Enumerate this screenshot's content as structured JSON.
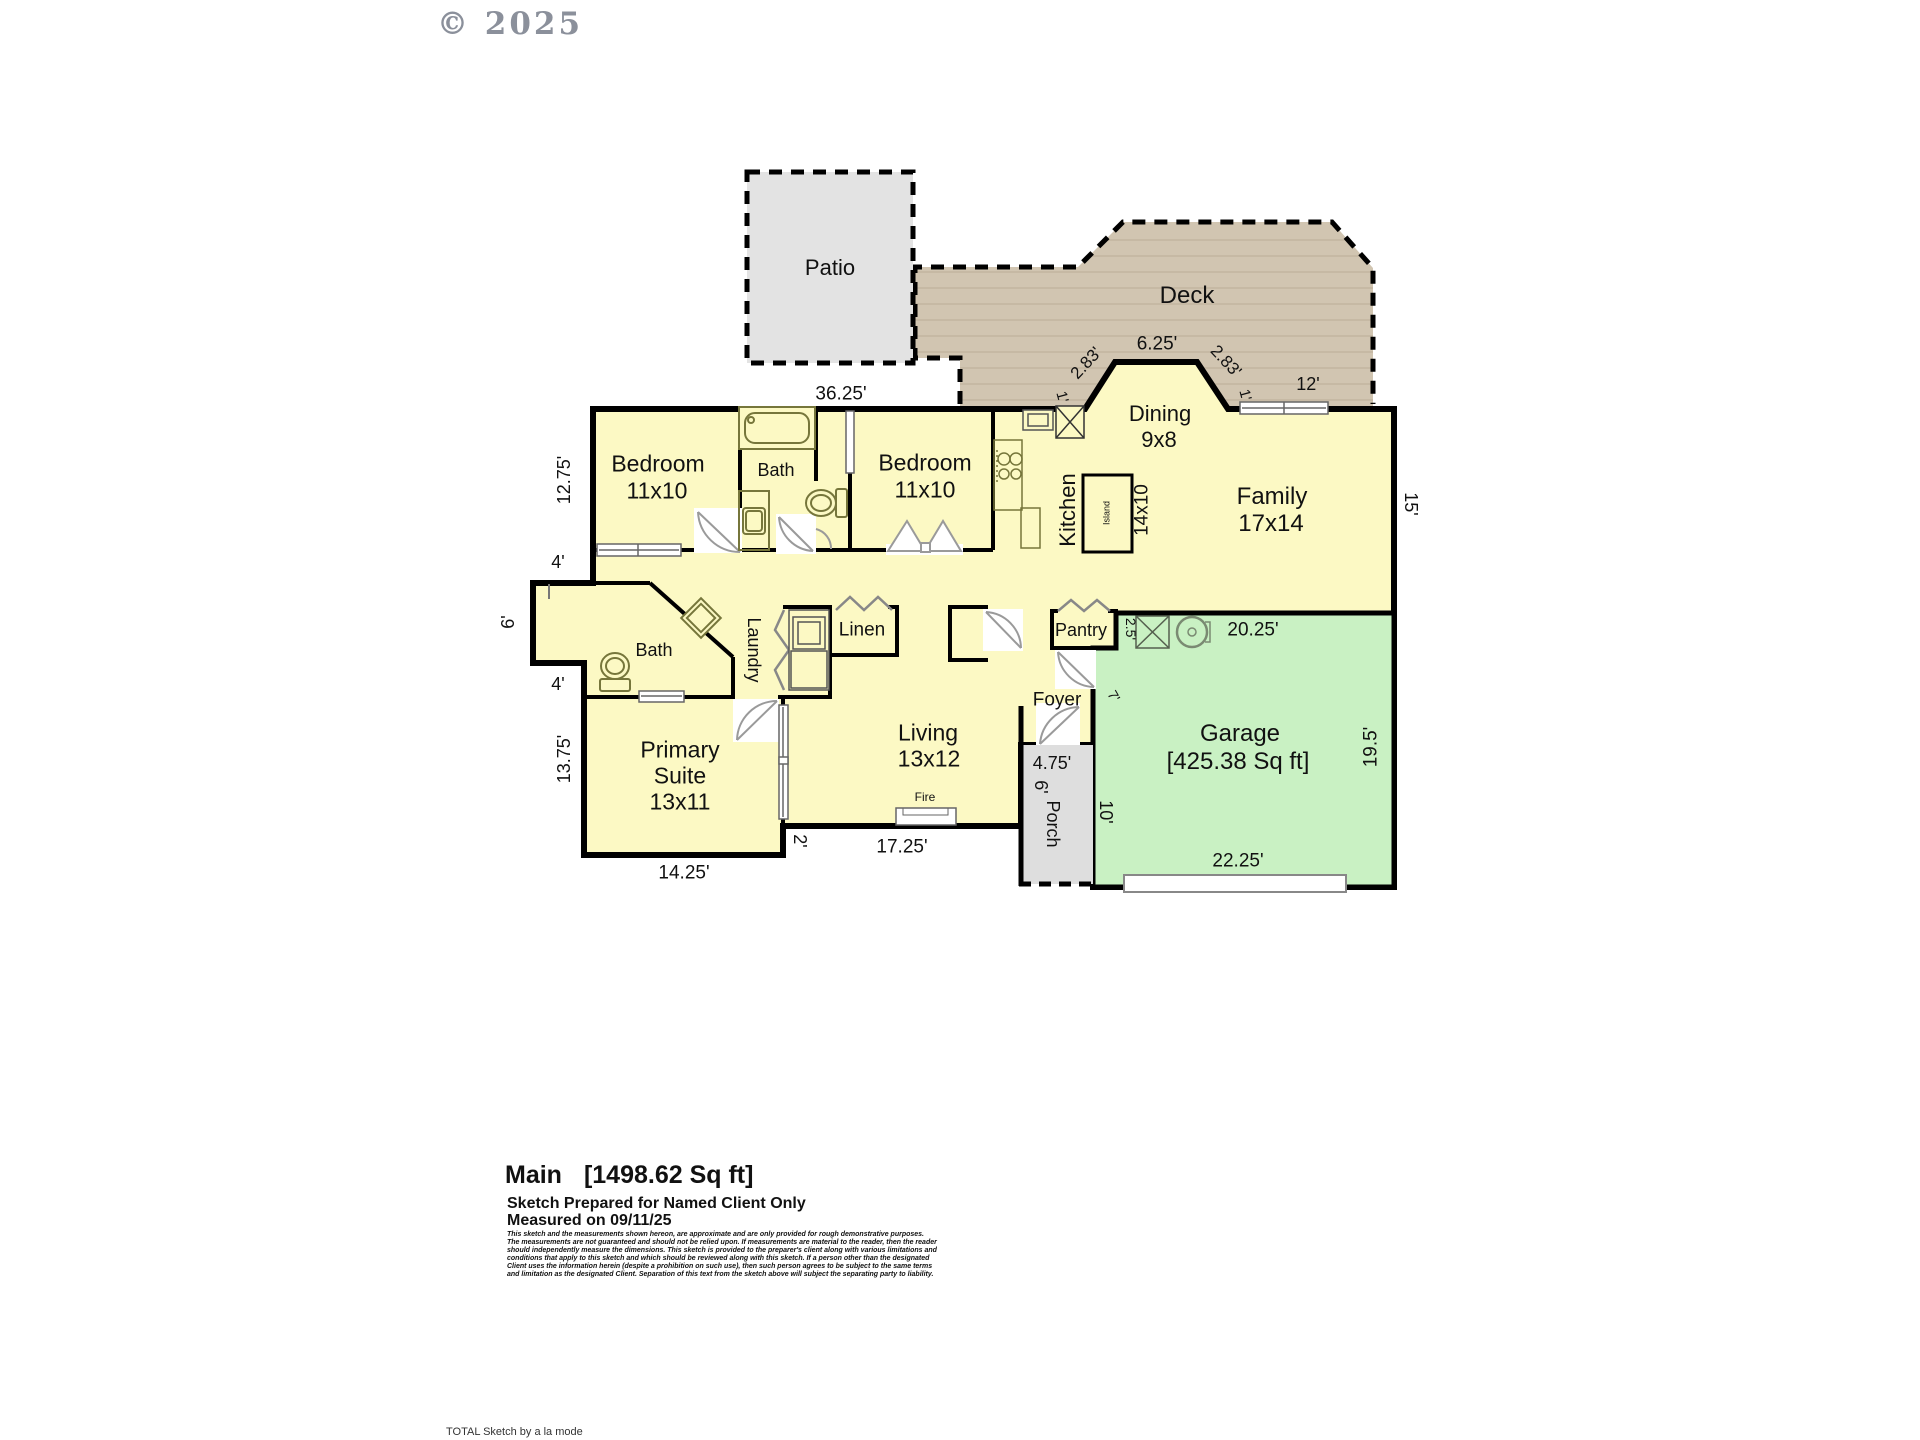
{
  "copyright": "© 2025",
  "areas": {
    "patio": {
      "label": "Patio"
    },
    "deck": {
      "label": "Deck"
    },
    "dining": {
      "label": "Dining",
      "dims": "9x8"
    },
    "family": {
      "label": "Family",
      "dims": "17x14"
    },
    "kitchen": {
      "label": "Kitchen",
      "dims": "14x10",
      "island": "Island"
    },
    "bedroom1": {
      "label": "Bedroom",
      "dims": "11x10"
    },
    "bedroom2": {
      "label": "Bedroom",
      "dims": "11x10"
    },
    "bath1": {
      "label": "Bath"
    },
    "bath2": {
      "label": "Bath"
    },
    "laundry": {
      "label": "Laundry"
    },
    "linen": {
      "label": "Linen"
    },
    "pantry": {
      "label": "Pantry"
    },
    "foyer": {
      "label": "Foyer"
    },
    "living": {
      "label": "Living",
      "dims": "13x12"
    },
    "primary": {
      "line1": "Primary",
      "line2": "Suite",
      "dims": "13x11"
    },
    "porch": {
      "label": "Porch"
    },
    "garage": {
      "label": "Garage",
      "area": "[425.38 Sq ft]"
    },
    "fireplace": {
      "label": "Fire"
    }
  },
  "dimensions": {
    "patio_width": "36.25'",
    "deck_bay_top": "6.25'",
    "deck_diag_left": "2.83'",
    "deck_diag_right": "2.83'",
    "deck_side_left": "1'",
    "deck_side_right": "1'",
    "deck_window": "12'",
    "family_right": "15'",
    "bedroom_left": "12.75'",
    "hall_left_top": "4'",
    "bump_left": "6'",
    "hall_left_bottom": "4'",
    "primary_left": "13.75'",
    "primary_bottom": "14.25'",
    "living_step": "2'",
    "living_bottom": "17.25'",
    "porch_top": "4.75'",
    "porch_width": "6'",
    "porch_right": "10'",
    "foyer_garage": "7'",
    "pantry_side": "2.5'",
    "garage_top": "20.25'",
    "garage_right": "19.5'",
    "garage_bottom": "22.25'"
  },
  "footer": {
    "title_name": "Main",
    "title_area": "[1498.62 Sq ft]",
    "prepared": "Sketch Prepared for Named Client Only",
    "measured": "Measured on 09/11/25",
    "disclaimer_lines": [
      "This sketch and the measurements shown hereon, are approximate and are only provided for rough demonstrative purposes.",
      "The measurements are not guaranteed and should not be relied upon.  If measurements are material to the reader, then the reader",
      "should independently measure the dimensions.  This sketch is provided to the preparer's client along with various limitations and",
      "conditions that apply to this sketch and which should be reviewed along with this sketch.  If a person other than the designated",
      "Client uses the information herein (despite a prohibition on such use), then such person agrees to be subject to the same terms",
      "and limitation as the designated Client.  Separation of this text from the sketch above will subject the separating party to liability."
    ],
    "brand": "TOTAL Sketch by a la mode"
  },
  "colors": {
    "house_fill": "#FCF9C4",
    "garage_fill": "#C9F1C3",
    "deck_fill": "#D1C5B1",
    "deck_plank": "#C2B5A0",
    "patio_fill": "#E3E3E3",
    "porch_fill": "#DEDEDE",
    "wall": "#000000",
    "fixture": "#76763B"
  }
}
